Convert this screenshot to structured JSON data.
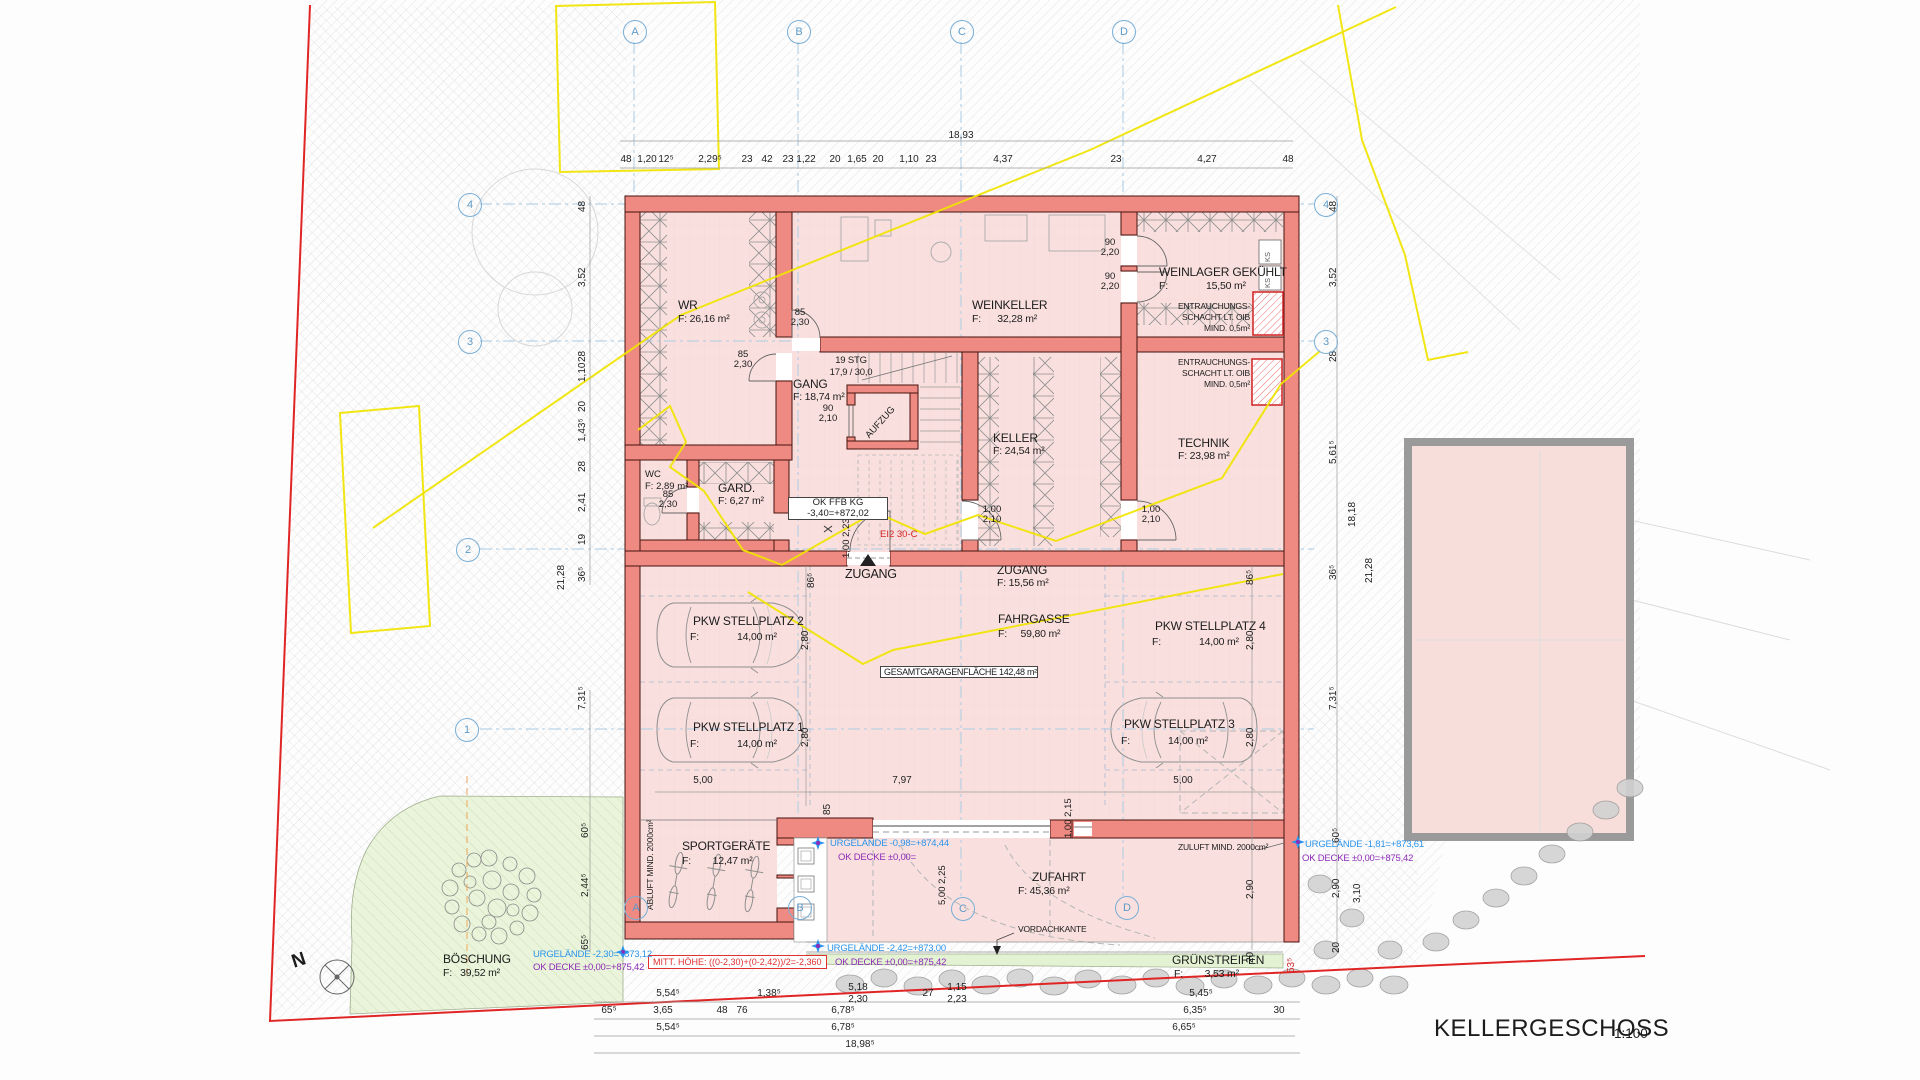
{
  "title": {
    "name": "KELLERGESCHOSS",
    "scale": "1:100"
  },
  "axes": {
    "a": "A",
    "b": "B",
    "c": "C",
    "d": "D",
    "n1": "1",
    "n2": "2",
    "n3": "3",
    "n4": "4"
  },
  "rooms": {
    "wr": {
      "name": "WR",
      "area": "F: 26,16 m²"
    },
    "weinkeller": {
      "name": "WEINKELLER",
      "area": "F:      32,28 m²"
    },
    "weinlager": {
      "name": "WEINLAGER GEKÜHLT",
      "area": "F:              15,50 m²"
    },
    "gang": {
      "name": "GANG",
      "area": "F: 18,74 m²"
    },
    "keller": {
      "name": "KELLER",
      "area": "F: 24,54 m²"
    },
    "technik": {
      "name": "TECHNIK",
      "area": "F: 23,98 m²"
    },
    "wc": {
      "name": "WC",
      "area": "F: 2,89 m²"
    },
    "gard": {
      "name": "GARD.",
      "area": "F: 6,27 m²"
    },
    "aufzug": {
      "name": "AUFZUG"
    },
    "zugang": {
      "name": "ZUGANG",
      "area": "F: 15,56 m²"
    },
    "fahrgasse": {
      "name": "FAHRGASSE",
      "area": "F:     59,80 m²"
    },
    "sp1": {
      "name": "PKW STELLPLATZ 1",
      "area": "F:              14,00 m²"
    },
    "sp2": {
      "name": "PKW STELLPLATZ 2",
      "area": "F:              14,00 m²"
    },
    "sp3": {
      "name": "PKW STELLPLATZ 3",
      "area": "F:              14,00 m²"
    },
    "sp4": {
      "name": "PKW STELLPLATZ 4",
      "area": "F:              14,00 m²"
    },
    "sport": {
      "name": "SPORTGERÄTE",
      "area": "F:        12,47 m²"
    },
    "zufahrt": {
      "name": "ZUFAHRT",
      "area": "F: 45,36 m²"
    },
    "boeschung": {
      "name": "BÖSCHUNG",
      "area": "F:   39,52 m²"
    },
    "gruenstreifen": {
      "name": "GRÜNSTREIFEN",
      "area": "F:        3,53 m²"
    }
  },
  "doors": {
    "wr": [
      "85",
      "2,30"
    ],
    "gang_wk": [
      "85",
      "2,30"
    ],
    "wl1": [
      "90",
      "2,20"
    ],
    "wl2": [
      "90",
      "2,20"
    ],
    "lift": [
      "90",
      "2,10"
    ],
    "wc": [
      "85",
      "2,30"
    ],
    "keller": [
      "1,00",
      "2,10"
    ],
    "technik": [
      "1,00",
      "2,10"
    ],
    "entry": [
      "1,00",
      "2,23⁵"
    ],
    "tor": [
      "5,00",
      "2,25"
    ],
    "nebentuer": [
      "1,00",
      "2,15"
    ]
  },
  "ann": {
    "stg1": "19 STG",
    "stg2": "17,9 / 30,0",
    "okffb1": "OK FFB KG",
    "okffb2": "-3,40=+872,02",
    "gesamt": "GESAMTGARAGENFLÄCHE 142,48 m²",
    "ent1": "ENTRAUCHUNGS-",
    "ent2": "SCHACHT LT. OIB",
    "ent3": "MIND. 0,5m²",
    "ks": "KS",
    "ei2": "EI2 30-C",
    "zugang_pfeil": "ZUGANG",
    "abluft": "ABLUFT MIND. 2000cm²",
    "zuluft": "ZULUFT MIND. 2000cm²",
    "vordach": "VORDACHKANTE",
    "mitt": "MITT. HÖHE: ((0-2,30)+(0-2,42))/2=-2,360",
    "urg1a": "URGELÄNDE -2,30=+873,12",
    "urg1b": "OK DECKE ±0,00=+875,42",
    "urg2a": "URGELÄNDE -0,98=+874,44",
    "urg2b": "OK DECKE ±0,00=",
    "urg3a": "URGELÄNDE -2,42=+873,00",
    "urg3b": "OK DECKE ±0,00=+875,42",
    "urg4a": "URGELÄNDE -1,81=+873,61",
    "urg4b": "OK DECKE ±0,00=+875,42",
    "north": "N"
  },
  "dims": {
    "top_total": "18,93",
    "top": [
      "48",
      "1,20",
      "12⁵",
      "2,29⁵",
      "23",
      "42",
      "23",
      "1,22",
      "20",
      "1,65",
      "20",
      "1,10",
      "23",
      "4,37",
      "23",
      "4,27",
      "48"
    ],
    "left": [
      "48",
      "3,52",
      "28",
      "1,10",
      "20",
      "1,43⁵",
      "28",
      "2,41",
      "19",
      "36⁵"
    ],
    "left_total": "21,28",
    "left_lower": [
      "7,31⁵",
      "60⁵",
      "2,44⁵",
      "65⁵"
    ],
    "right": [
      "48",
      "3,52",
      "28",
      "5,61⁵",
      "36⁵",
      "7,31⁵",
      "60⁵",
      "2,90",
      "20"
    ],
    "right2": [
      "18,18",
      "3,10"
    ],
    "right_total": "21,28",
    "gar_right": [
      "86⁵",
      "2,80",
      "2,80",
      "2,90",
      "20"
    ],
    "gar_left": [
      "86⁵",
      "2,80",
      "2,80",
      "85"
    ],
    "gar_bottom": [
      "5,00",
      "7,97",
      "5,00"
    ],
    "grenz": "53⁵",
    "row1": [
      "5,54⁵",
      "1,38⁵",
      "5,18",
      "2,30",
      "27",
      "1,15",
      "2,23",
      "5,45⁵"
    ],
    "row2": [
      "65⁵",
      "3,65",
      "48",
      "76",
      "6,78⁵",
      "6,35⁵",
      "30"
    ],
    "row3": [
      "5,54⁵",
      "6,78⁵",
      "6,65⁵"
    ],
    "row4": "18,98⁵"
  }
}
